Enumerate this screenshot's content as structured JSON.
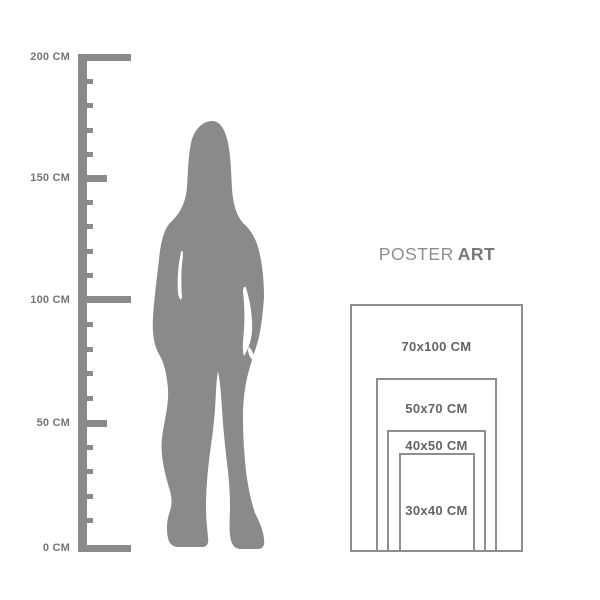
{
  "title": "Poster size guide with human height reference",
  "ruler": {
    "unit": "CM",
    "max_cm": 200,
    "labels": [
      {
        "text": "200 CM",
        "cm": 200
      },
      {
        "text": "150 CM",
        "cm": 150
      },
      {
        "text": "100 CM",
        "cm": 100
      },
      {
        "text": "50 CM",
        "cm": 50
      },
      {
        "text": "0 CM",
        "cm": 0
      }
    ]
  },
  "figure": {
    "alt": "standing woman silhouette"
  },
  "brand": {
    "word1": "POSTER",
    "word2": "ART"
  },
  "poster_sizes": [
    {
      "label": "70x100 CM",
      "width_cm": 70,
      "height_cm": 100
    },
    {
      "label": "50x70 CM",
      "width_cm": 50,
      "height_cm": 70
    },
    {
      "label": "40x50 CM",
      "width_cm": 40,
      "height_cm": 50
    },
    {
      "label": "30x40 CM",
      "width_cm": 30,
      "height_cm": 40
    }
  ],
  "colors": {
    "background": "#ffffff",
    "silhouette": "#8a8a8a",
    "ruler": "#8a8a8a",
    "ruler_text": "#757575",
    "frame_border": "#8f8f8f",
    "frame_text": "#646464",
    "brand_regular": "#8e8e8e",
    "brand_bold": "#787878"
  }
}
